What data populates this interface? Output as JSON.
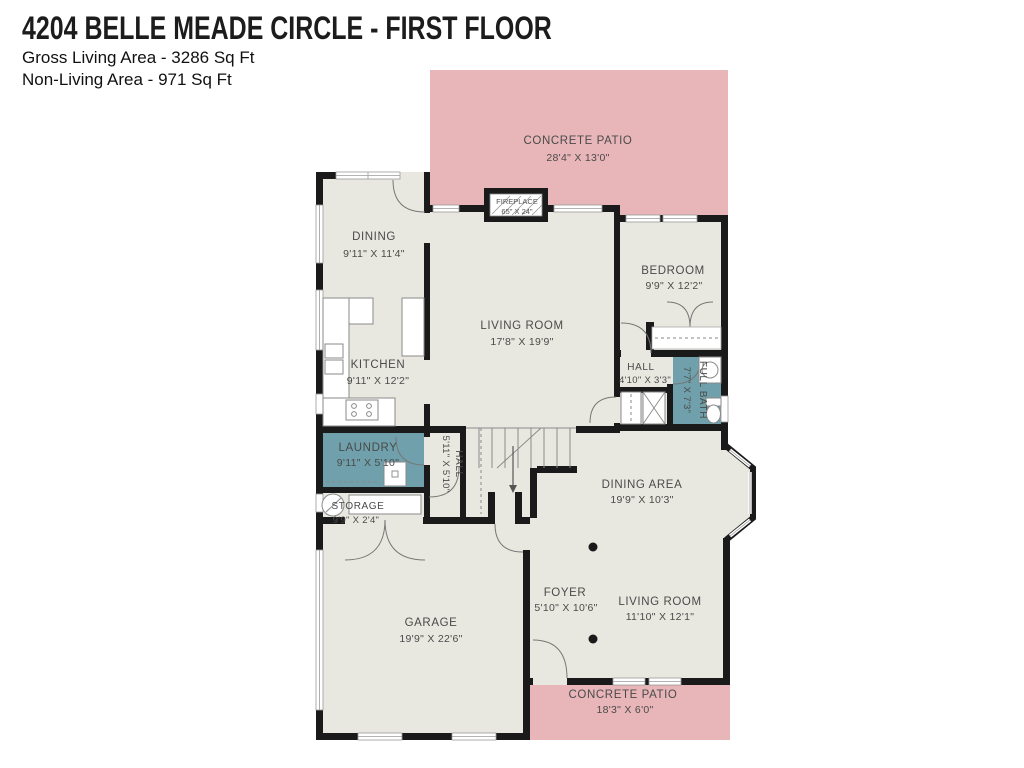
{
  "header": {
    "title": "4204 BELLE MEADE CIRCLE - FIRST FLOOR",
    "subtitle1": "Gross Living Area - 3286 Sq Ft",
    "subtitle2": "Non-Living Area - 971 Sq Ft"
  },
  "colors": {
    "patio": "#e8b6b9",
    "floor": "#e9e8e0",
    "wet": "#6fa0ab",
    "wall": "#1a1a1a",
    "label_text": "#4a4a4a"
  },
  "rooms": {
    "patio_top": {
      "name": "CONCRETE PATIO",
      "dims": "28'4\" X 13'0\""
    },
    "fireplace": {
      "name": "FIREPLACE",
      "dims": "65\" X 24\""
    },
    "dining": {
      "name": "DINING",
      "dims": "9'11\" X 11'4\""
    },
    "kitchen": {
      "name": "KITCHEN",
      "dims": "9'11\" X 12'2\""
    },
    "living_room": {
      "name": "LIVING ROOM",
      "dims": "17'8\" X 19'9\""
    },
    "bedroom": {
      "name": "BEDROOM",
      "dims": "9'9\" X 12'2\""
    },
    "hall": {
      "name": "HALL",
      "dims": "4'10\" X 3'3\""
    },
    "full_bath": {
      "name": "FULL BATH",
      "dims": "7'7\" X 7'3\""
    },
    "laundry": {
      "name": "LAUNDRY",
      "dims": "9'11\" X 5'10\""
    },
    "hall_center": {
      "name": "HALL",
      "dims": "5'11\" X 5'10\""
    },
    "storage": {
      "name": "STORAGE",
      "dims": "9'9\" X 2'4\""
    },
    "garage": {
      "name": "GARAGE",
      "dims": "19'9\" X 22'6\""
    },
    "foyer": {
      "name": "FOYER",
      "dims": "5'10\" X 10'6\""
    },
    "dining_area": {
      "name": "DINING AREA",
      "dims": "19'9\" X 10'3\""
    },
    "living_room_2": {
      "name": "LIVING ROOM",
      "dims": "11'10\" X 12'1\""
    },
    "patio_bottom": {
      "name": "CONCRETE PATIO",
      "dims": "18'3\" X 6'0\""
    }
  }
}
